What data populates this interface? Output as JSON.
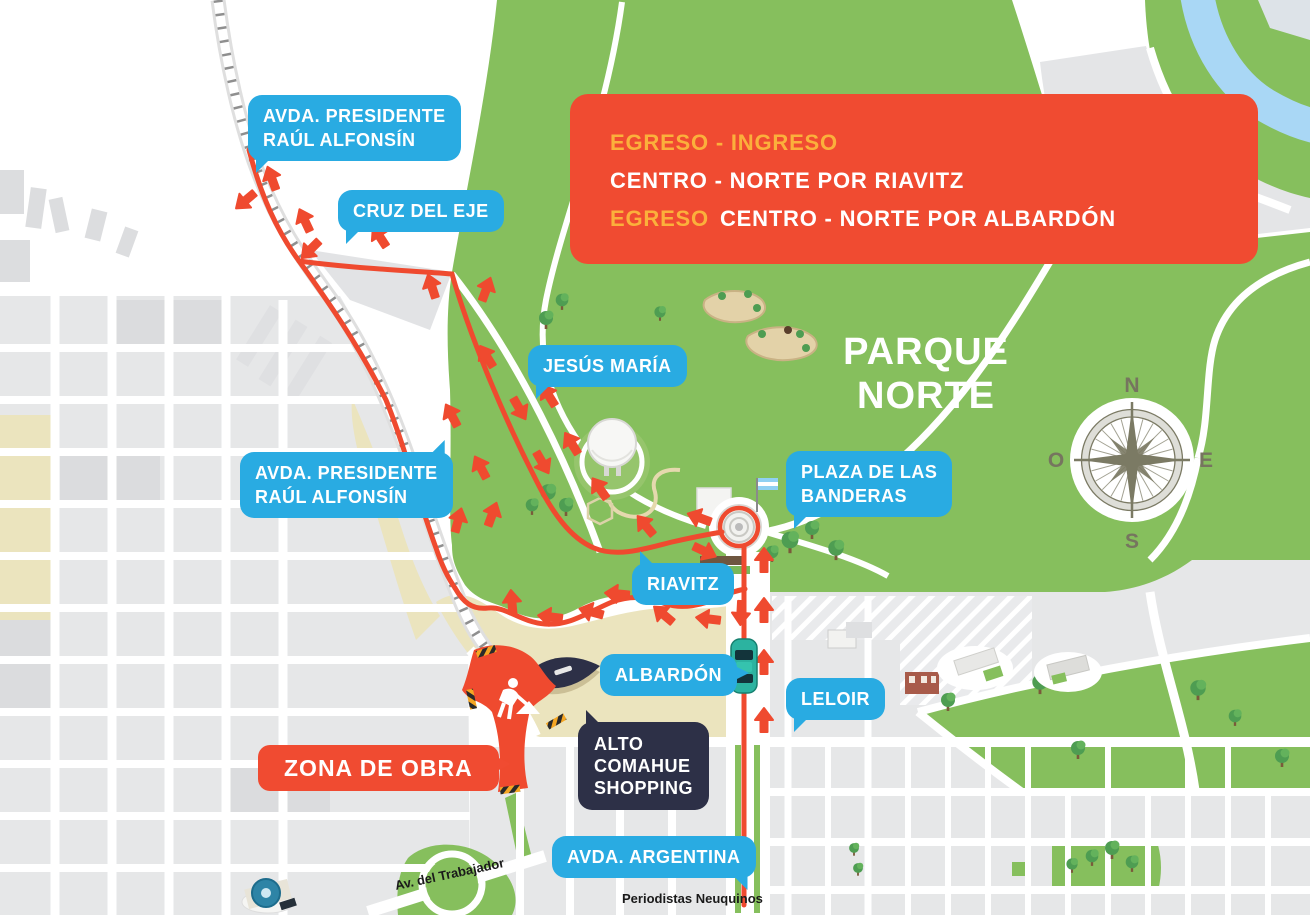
{
  "banner": {
    "line1": "EGRESO - INGRESO",
    "line2": "CENTRO - NORTE POR RIAVITZ",
    "line3_highlight": "EGRESO",
    "line3_rest": "CENTRO - NORTE POR ALBARDÓN"
  },
  "park": {
    "name_line1": "PARQUE",
    "name_line2": "NORTE"
  },
  "labels": {
    "alfonsin_top": {
      "line1": "AVDA. PRESIDENTE",
      "line2": "RAÚL ALFONSÍN"
    },
    "cruz_del_eje": "CRUZ DEL EJE",
    "jesus_maria": "JESÚS MARÍA",
    "alfonsin_mid": {
      "line1": "AVDA. PRESIDENTE",
      "line2": "RAÚL ALFONSÍN"
    },
    "plaza_banderas": {
      "line1": "PLAZA DE LAS",
      "line2": "BANDERAS"
    },
    "riavitz": "RIAVITZ",
    "albardon": "ALBARDÓN",
    "leloir": "LELOIR",
    "avda_argentina": "AVDA. ARGENTINA",
    "zona_de_obra": "ZONA DE OBRA",
    "shopping": {
      "line1": "ALTO",
      "line2": "COMAHUE",
      "line3": "SHOPPING"
    }
  },
  "minor_streets": {
    "trabajador": "Av. del Trabajador",
    "periodistas": "Periodistas Neuquinos"
  },
  "compass": {
    "n": "N",
    "e": "E",
    "s": "S",
    "o": "O"
  },
  "colors": {
    "route_red": "#EF4A2F",
    "banner_red": "#F04B31",
    "label_blue": "#29ABE2",
    "highlight_yellow": "#FBB03B",
    "park_green": "#86BF5D",
    "navy": "#2D3047",
    "river_blue": "#A9D7F5",
    "compass_olive": "#7B7A64"
  }
}
